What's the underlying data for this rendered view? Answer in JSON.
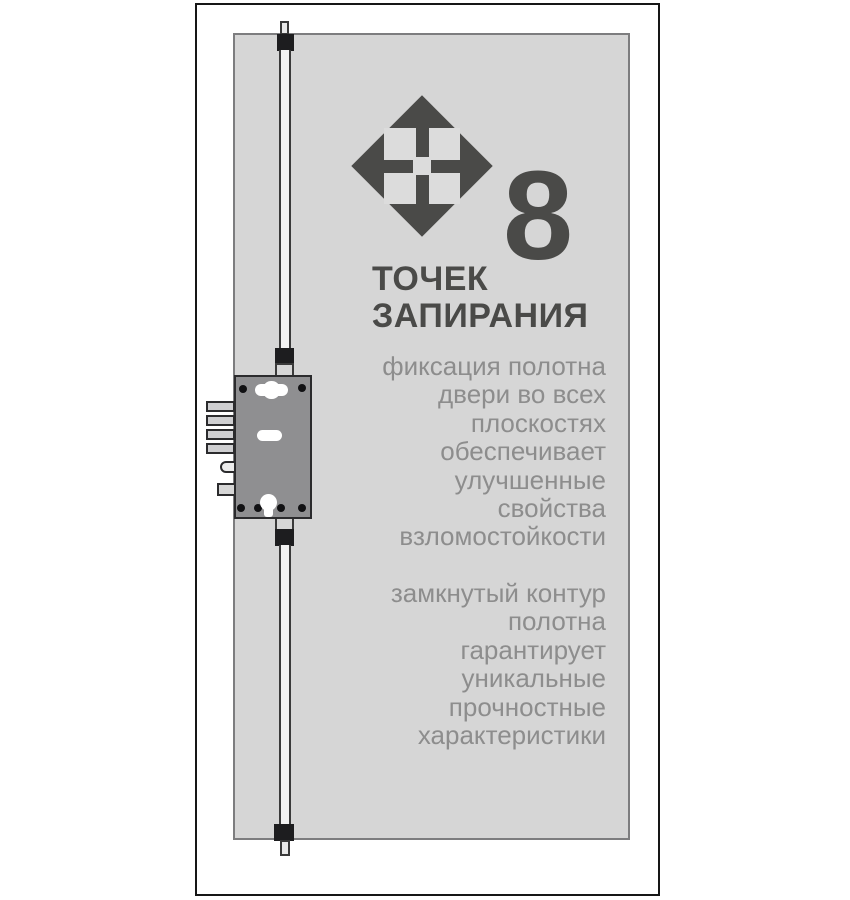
{
  "colors": {
    "accent_dark": "#4a4a48",
    "body_text_gray": "#8d8d8d",
    "door_panel_gray": "#d6d6d6",
    "lock_body_gray": "#8f8f91",
    "hardware_black": "#1d1d1f"
  },
  "icons": {
    "brand": "diamond-cross-lock-icon",
    "keyhole": "keyhole-icon",
    "spindle": "handle-spindle-icon"
  },
  "infographic": {
    "badge_number": "8",
    "headline": "ТОЧЕК\nЗАПИРАНИЯ",
    "paragraph_1": "фиксация полотна\nдвери во всех\nплоскостях\nобеспечивает\nулучшенные\nсвойства\nвзломостойкости",
    "paragraph_2": "замкнутый контур\nполотна\nгарантирует\nуникальные\nпрочностные\nхарактеристики"
  }
}
